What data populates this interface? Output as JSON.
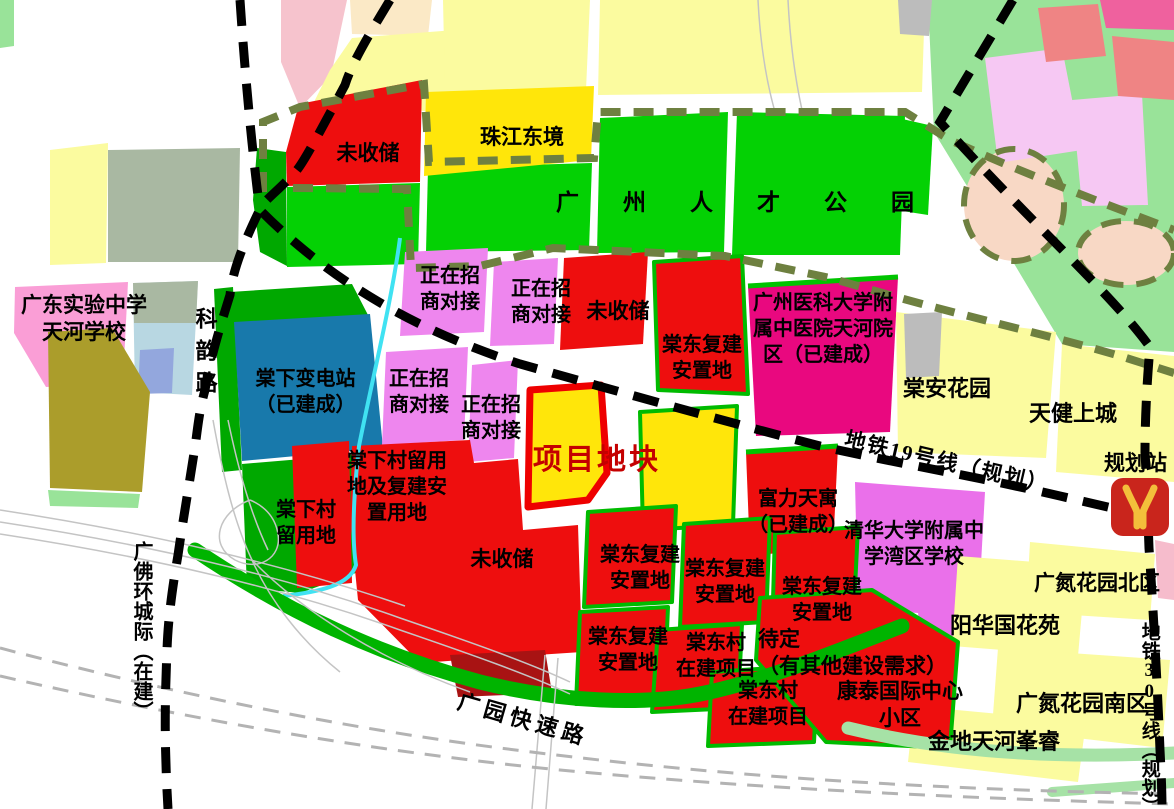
{
  "map_type": "urban-planning-parcel-map",
  "palette": {
    "red_parcel": "#ee0e0e",
    "dark_red_parcel": "#a81313",
    "bright_green_park": "#04d104",
    "mid_green": "#00a800",
    "pale_green": "#99e399",
    "bright_yellow": "#ffe60a",
    "pale_yellow": "#fbfb9f",
    "pink_negotiating": "#ee86ee",
    "magenta_hospital": "#e9087f",
    "violet_school": "#ea70ea",
    "school_pink": "#fa9ed6",
    "teal_substation": "#1879ab",
    "olive_parcel": "#ab9d2b",
    "boundary_olive_dash": "#6e8040",
    "metro_line_black": "#000000",
    "project_outline_red": "#ee0000",
    "project_label_red": "#c40000",
    "metro_logo_red": "#c9251c",
    "metro_logo_yellow": "#f3bf3b"
  },
  "labels": {
    "gd_school": "广东实验中学\n天河学校",
    "keyun_road": "科韵路",
    "not_collected": "未收储",
    "zhujiang_east": "珠江东境",
    "talent_park": "广州人才公园",
    "negotiating": "正在招\n商对接",
    "tangdong_resettle": "棠东复建\n安置地",
    "hospital": "广州医科大学附\n属中医院天河院\n区（已建成）",
    "tangan": "棠安花园",
    "tianjian": "天健上城",
    "metro19": "地铁19号线（规划）",
    "station": "规划站",
    "substation": "棠下变电站\n（已建成）",
    "project": "项目地块",
    "liuyong_resettle": "棠下村留用\n地及复建安\n置用地",
    "liuyong": "棠下村\n留用地",
    "fuli": "富力天寓\n（已建成）",
    "tsinghua": "清华大学附属中\n学湾区学校",
    "gdn_north": "广氮花园北区",
    "yanghua": "阳华国花苑",
    "gdn_south": "广氮花园南区",
    "jindi": "金地天河峯睿",
    "kangtai": "康泰国际中心\n小区",
    "pending": "待定\n（有其他建设需求）",
    "village_project": "棠东村\n在建项目",
    "guangyuan": "广园快速路",
    "gfh": "广佛环城际（在建）",
    "metro30": "地铁30号线（规划）"
  }
}
